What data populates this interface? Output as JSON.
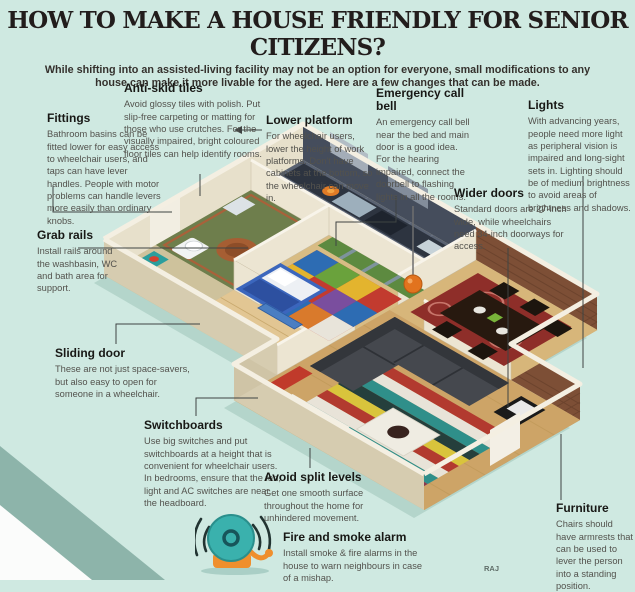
{
  "header": {
    "title": "HOW TO MAKE A HOUSE FRIENDLY FOR SENIOR CITIZENS?",
    "subtitle": "While shifting into an assisted-living facility may not be an option for everyone, small modifications to any house can make it more livable for the aged. Here are a few changes that can be made."
  },
  "annotations": [
    {
      "id": "fittings",
      "heading": "Fittings",
      "body": "Bathroom basins can be fitted lower for easy access to wheelchair users, and taps can have lever handles. People with motor problems can handle levers more easily than ordinary knobs."
    },
    {
      "id": "anti-skid-tiles",
      "heading": "Anti-skid tiles",
      "body": "Avoid glossy tiles with polish. Put slip-free carpeting or matting for those who use crutches. For the visually impaired, bright coloured floor tiles can help identify rooms."
    },
    {
      "id": "lower-platform",
      "heading": "Lower platform",
      "body": "For wheelchair users, lower the height of work platforms. Don't have cabinets at the bottom, so the wheelchair can move in."
    },
    {
      "id": "emergency-call-bell",
      "heading": "Emergency call bell",
      "body": "An emergency call bell near the bed and main door is a good idea. For the hearing impaired, connect the doorbell to flashing lights in all the rooms."
    },
    {
      "id": "lights",
      "heading": "Lights",
      "body": "With advancing years, people need more light as peripheral vision is impaired and long-sight sets in. Lighting should be of medium brightness to avoid areas of brightness and shadows."
    },
    {
      "id": "wider-doors",
      "heading": "Wider doors",
      "body": "Standard doors are 27-inch wide, while wheelchairs need 34-inch doorways for access."
    },
    {
      "id": "grab-rails",
      "heading": "Grab rails",
      "body": "Install rails around the washbasin, WC and bath area for support."
    },
    {
      "id": "sliding-door",
      "heading": "Sliding door",
      "body": "These are not just space-savers, but also easy to open for someone in a wheelchair."
    },
    {
      "id": "switchboards",
      "heading": "Switchboards",
      "body": "Use big switches and put switchboards at a height that is convenient for wheelchair users. In bedrooms, ensure that the fan, light and AC switches are near the headboard."
    },
    {
      "id": "avoid-split-levels",
      "heading": "Avoid split levels",
      "body": "Get one smooth surface throughout the home for unhindered movement."
    },
    {
      "id": "fire-and-smoke-alarm",
      "heading": "Fire and smoke alarm",
      "body": "Install smoke & fire alarms in the house to warn neighbours in case of a mishap."
    },
    {
      "id": "furniture",
      "heading": "Furniture",
      "body": "Chairs should have armrests that can be used to lever the person into a standing position."
    }
  ],
  "icons": {
    "alarm_bell": "fire-alarm-bell-icon"
  },
  "credit": "RAJ",
  "colors": {
    "background": "#cfe9e1",
    "corner_teal": "#8db4aa",
    "title_text": "#221d1c",
    "body_text": "#53524d",
    "leader_line": "#3f4443",
    "bell_teal": "#3ab1ad",
    "bell_orange": "#ef8f2d",
    "brick_wall": "#7d4f36",
    "cream_wall": "#d6ccb0"
  }
}
